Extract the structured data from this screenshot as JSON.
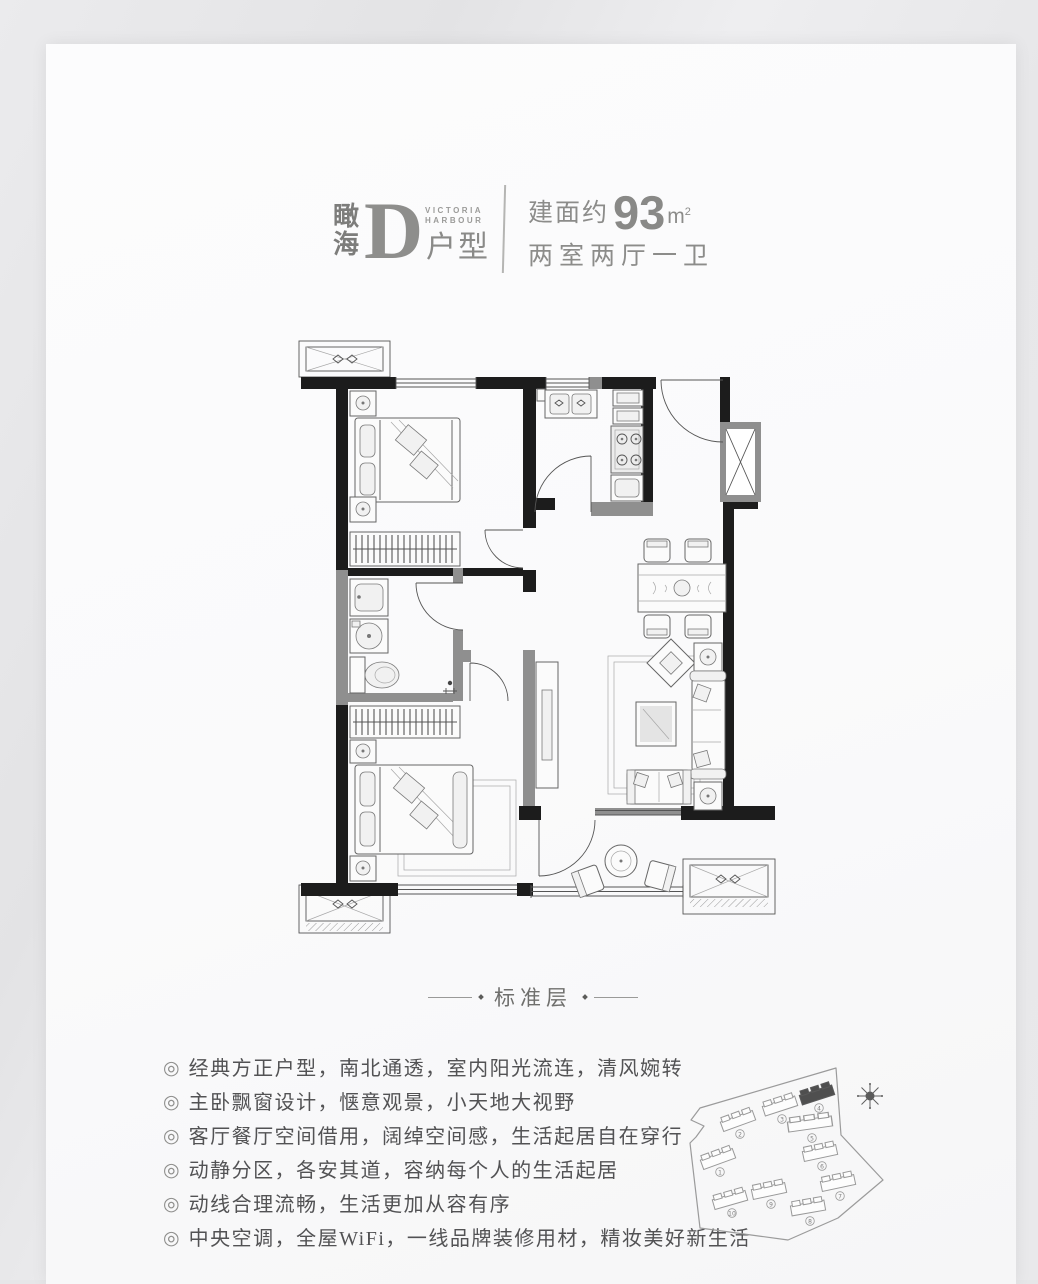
{
  "header": {
    "brand_cn": "瞰海",
    "unit_letter": "D",
    "unit_suffix": "户型",
    "brand_en_line1": "VICTORIA",
    "brand_en_line2": "HARBOUR",
    "area_label": "建面约",
    "area_value": "93",
    "area_unit_base": "m",
    "area_unit_sup": "2",
    "layout_text": "两室两厅一卫"
  },
  "plan": {
    "caption": "标准层"
  },
  "features": {
    "bullet": "◎",
    "items": [
      "经典方正户型，南北通透，室内阳光流连，清风婉转",
      "主卧飘窗设计，惬意观景，小天地大视野",
      "客厅餐厅空间借用，阔绰空间感，生活起居自在穿行",
      "动静分区，各安其道，容纳每个人的生活起居",
      "动线合理流畅，生活更加从容有序",
      "中央空调，全屋WiFi，一线品牌装修用材，精妆美好新生活"
    ]
  },
  "siteplan": {
    "buildings": [
      "1",
      "2",
      "3",
      "4",
      "5",
      "6",
      "7",
      "8",
      "9",
      "10"
    ],
    "highlighted_building": "4"
  },
  "colors": {
    "canvas_bg": "#e7e7e9",
    "page_bg": "#fbfbfc",
    "header_text": "#8c8c8a",
    "feature_text": "#525254",
    "wall_dark": "#1c1c1c",
    "wall_gray": "#8f8f8f",
    "site_highlight": "#4f4f4f"
  }
}
